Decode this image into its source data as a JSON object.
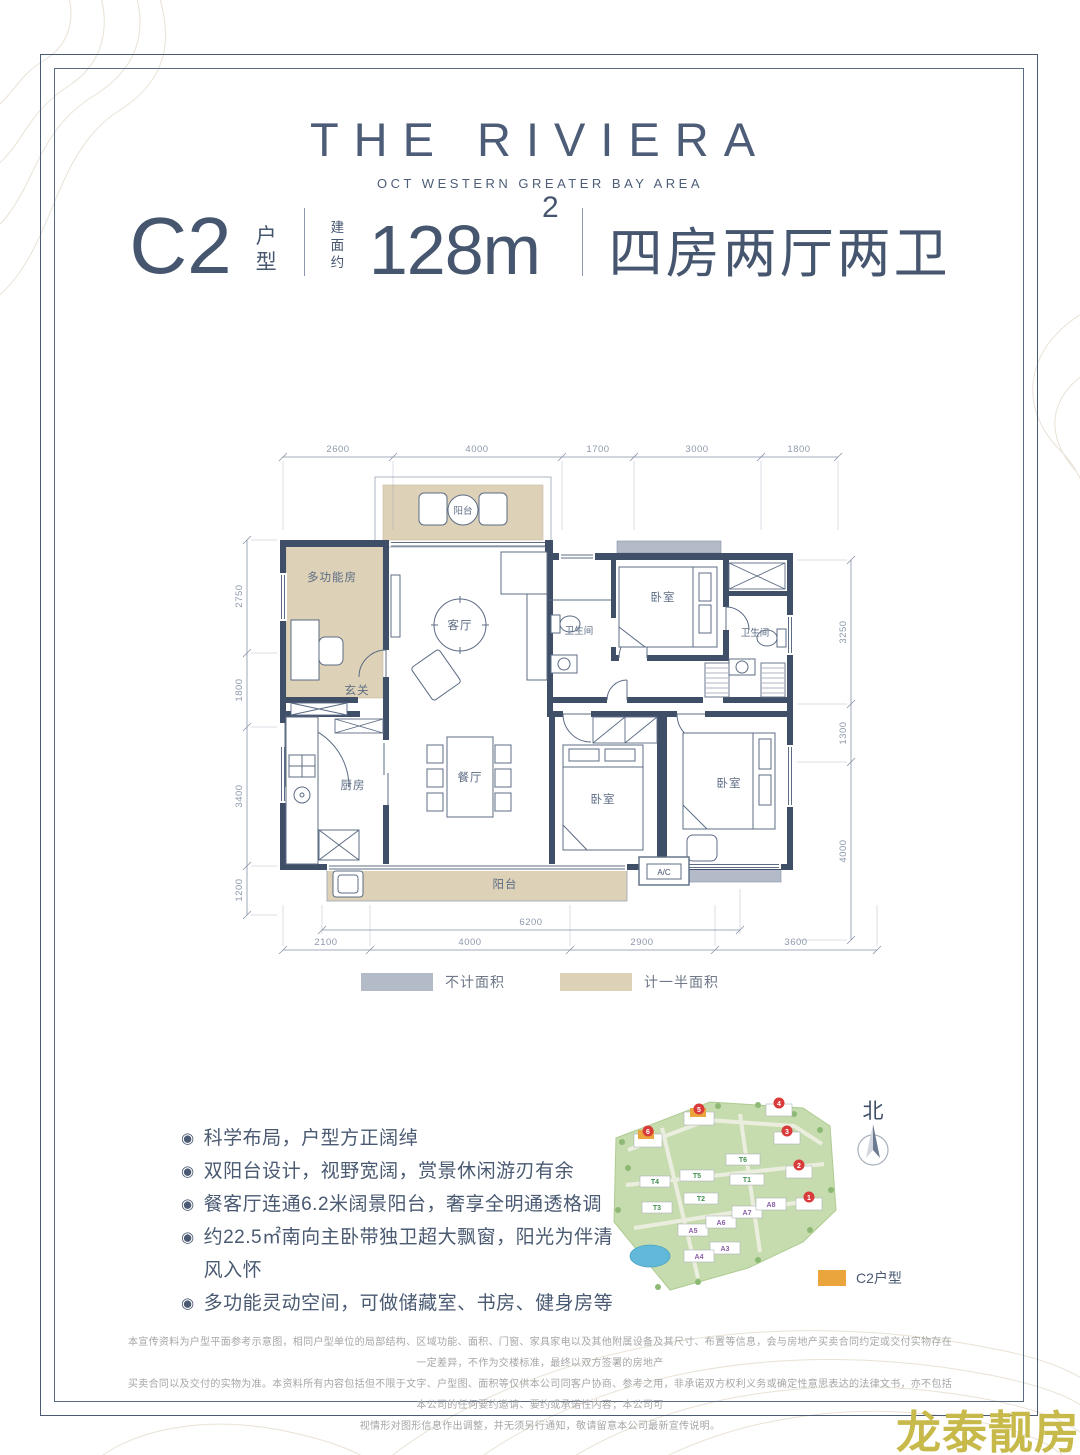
{
  "brand": {
    "title": "THE RIVIERA",
    "subtitle": "OCT WESTERN GREATER BAY AREA"
  },
  "spec": {
    "unit_code": "C2",
    "unit_suffix": "户型",
    "area_prefix": "建面约",
    "area_value": "128m",
    "area_exponent": "2",
    "layout_text": "四房两厅两卫"
  },
  "floorplan": {
    "dims_top": [
      "2600",
      "4000",
      "1700",
      "3000",
      "1800"
    ],
    "dims_left": [
      "2750",
      "1800",
      "3400",
      "1200"
    ],
    "dims_right": [
      "3250",
      "1300",
      "4000"
    ],
    "dims_bottom": [
      "2100",
      "4000",
      "2900",
      "3600"
    ],
    "dim_balcony": "6200",
    "rooms": {
      "balcony_top": "阳台",
      "multi_room": "多功能房",
      "living": "客厅",
      "bath_1": "卫生间",
      "bedroom_top": "卧室",
      "bath_2": "卫生间",
      "entry": "玄关",
      "kitchen": "厨房",
      "dining": "餐厅",
      "bedroom_mid": "卧室",
      "bedroom_right": "卧室",
      "balcony_bottom": "阳台",
      "ac": "A/C"
    },
    "wall_color": "#3f4f68",
    "half_area_color": "#ddd1b7",
    "excluded_area_color": "#b3bbc8"
  },
  "legend": {
    "items": [
      {
        "label": "不计面积",
        "color": "#b3bbc8"
      },
      {
        "label": "计一半面积",
        "color": "#ddd1b7"
      }
    ]
  },
  "features": {
    "bullet": "◉",
    "items": [
      "科学布局，户型方正阔绰",
      "双阳台设计，视野宽阔，赏景休闲游刃有余",
      "餐客厅连通6.2米阔景阳台，奢享全明通透格调",
      "约22.5㎡南向主卧带独卫超大飘窗，阳光为伴清风入怀",
      "多功能灵动空间，可做储藏室、书房、健身房等"
    ]
  },
  "sitemap": {
    "north_label": "北",
    "unit_legend": "C2户型",
    "unit_color": "#eaa63d",
    "tower_labels": [
      "T1",
      "T2",
      "T3",
      "T4",
      "T5",
      "T6"
    ],
    "block_labels": [
      "A3",
      "A4",
      "A5",
      "A6",
      "A7",
      "A8"
    ],
    "building_numbers": [
      "1",
      "2",
      "3",
      "4",
      "5",
      "6"
    ]
  },
  "disclaimer": {
    "line1": "本宣传资料为户型平面参考示意图，相同户型单位的局部结构、区域功能、面积、门窗、家具家电以及其他附属设备及其尺寸、布置等信息，会与房地产买卖合同约定或交付实物存在一定差异，不作为交楼标准，最终以双方签署的房地产",
    "line2": "买卖合同以及交付的实物为准。本资料所有内容包括但不限于文字、户型图、面积等仅供本公司同客户协商、参考之用，非承诺双方权利义务或确定性意思表达的法律文书，亦不包括本公司的任何要约邀请、要约或承诺性内容；本公司可",
    "line3": "视情形对图形信息作出调整，并无须另行通知，敬请留意本公司最新宣传说明。"
  },
  "watermark": "龙泰靓房"
}
